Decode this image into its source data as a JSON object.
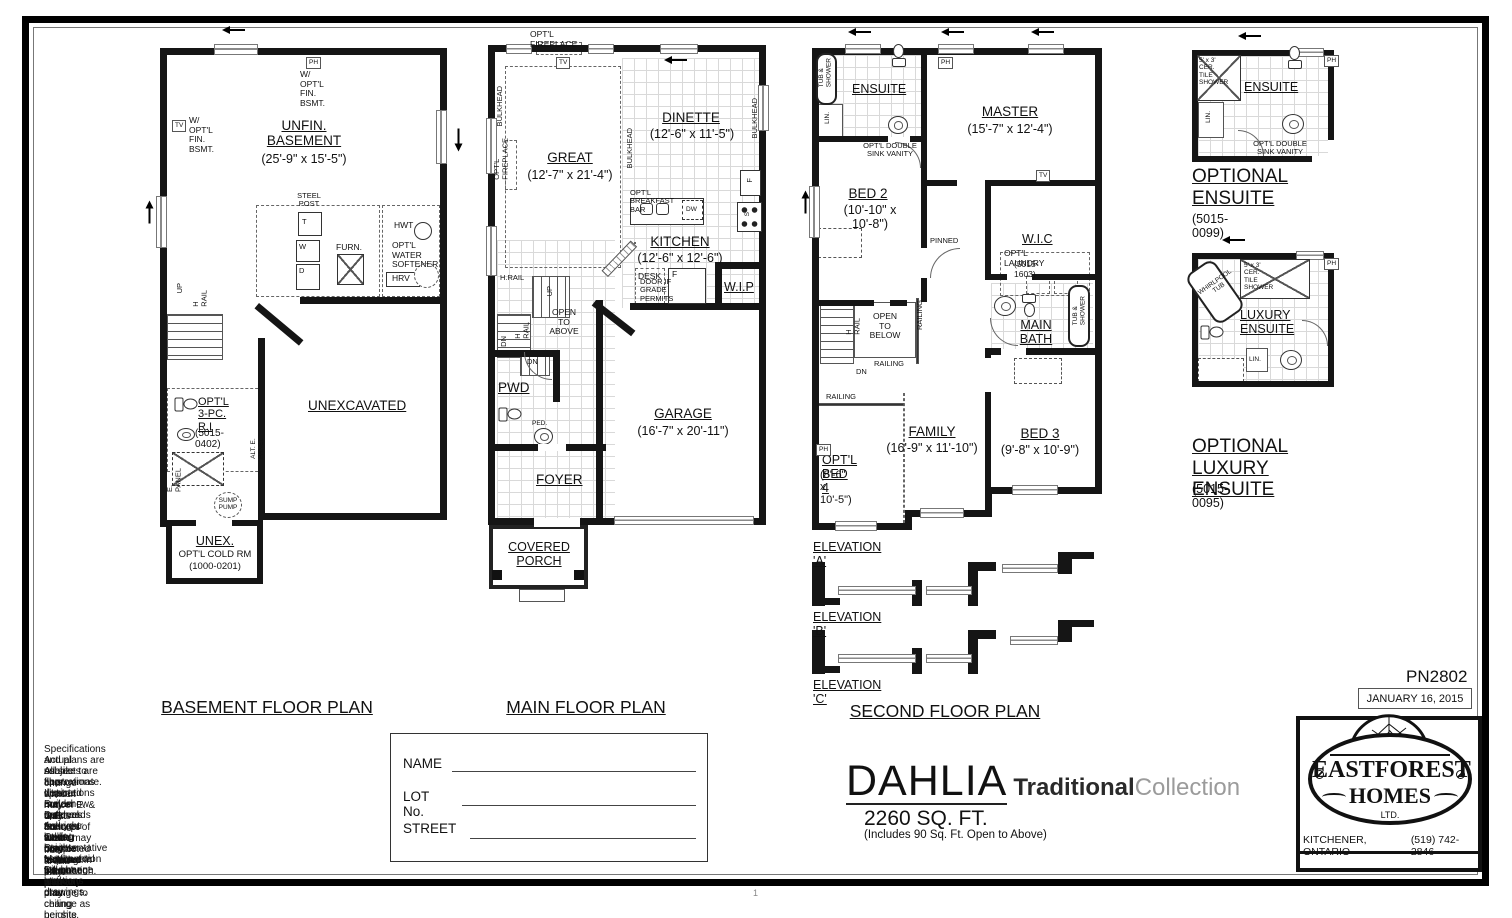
{
  "sheet": {
    "plan_code": "PN2802",
    "date": "JANUARY 16, 2015",
    "page_mark": "1"
  },
  "titles": {
    "basement": "BASEMENT FLOOR PLAN",
    "main": "MAIN FLOOR PLAN",
    "second": "SECOND FLOOR PLAN"
  },
  "model": {
    "name": "DAHLIA",
    "collection_primary": "Traditional",
    "collection_secondary": "Collection",
    "area": "2260 SQ. FT.",
    "area_note": "(Includes 90 Sq. Ft. Open to Above)"
  },
  "logo": {
    "brand_top": "EASTFOREST",
    "brand_bottom": "HOMES",
    "suffix": "LTD.",
    "city": "KITCHENER, ONTARIO",
    "phone": "(519) 742-2846"
  },
  "form": {
    "name": "NAME",
    "lot": "LOT No.",
    "street": "STREET"
  },
  "notes": [
    "Specifications and plans are subject to change without notice.  E. & O.E..",
    "Actual usable floor space may vary from stated floor area.",
    "All sizes are approximate.",
    "Illustrations depicted are an artists concept of the completed building only.",
    "Illustrations may show optional features which may not be included in the base price.",
    "Builder reserves the right to alter or reverse plans.",
    "Bulkheads and boxing may be required.",
    "Ask your sales representative for more information.",
    "Ceiling heights vary from plan to plan.",
    "Stair configuration will change with any change to ceiling heights.",
    "Mechanical equipment locations may change as per site conditions.",
    "Do not scale drawings."
  ],
  "basement": {
    "ph": "PH",
    "tv": "TV",
    "fin_bsmt_top": "W/ OPT'L\nFIN. BSMT.",
    "fin_bsmt_left": "W/ OPT'L\nFIN. BSMT.",
    "room": "UNFIN.\nBASEMENT",
    "room_size": "(25'-9\" x 15'-5\")",
    "steel_post": "STEEL\nPOST",
    "t": "T",
    "w": "W",
    "d": "D",
    "furn": "FURN.",
    "hwt": "HWT",
    "softener": "OPT'L\nWATER\nSOFTENER",
    "hrv": "HRV",
    "up": "UP",
    "h_rail": "H RAIL",
    "optl_3pc": "OPT'L\n3-PC. R.I",
    "optl_3pc_code": "(5015-0402)",
    "e_panel": "E. PANEL",
    "alt_e_panel": "ALT. E. PANEL",
    "sump": "SUMP\nPUMP",
    "unexcavated": "UNEXCAVATED",
    "unex": "UNEX.",
    "cold_rm": "OPT'L COLD RM",
    "cold_code": "(1000-0201)"
  },
  "main": {
    "optl_fireplace_top": "OPT'L FIREPLACE",
    "tv": "TV",
    "bulkhead_left": "BULKHEAD",
    "optl_fireplace_left": "OPT'L\nFIREPLACE",
    "great": "GREAT",
    "great_size": "(12'-7\" x 21'-4\")",
    "bulkhead_mid": "BULKHEAD",
    "bulkhead_right": "BULKHEAD",
    "dinette": "DINETTE",
    "dinette_size": "(12'-6\" x 11'-5\")",
    "breakfast_bar": "OPT'L BREAKFAST BAR",
    "dw": "DW",
    "fridge": "F",
    "stove": "S",
    "kitchen": "KITCHEN",
    "kitchen_size": "(12'-6\" x 12'-6\")",
    "desk": "DESK",
    "f": "F",
    "wip": "W.I.P",
    "door_grade": "DOOR IF\nGRADE\nPERMITS",
    "h_rail": "H.RAIL",
    "up": "UP",
    "open_above": "OPEN\nTO\nABOVE",
    "dn": "DN",
    "h_rail2": "H RAIL",
    "dn2": "DN",
    "pwd": "PWD",
    "ped": "PED.",
    "foyer": "FOYER",
    "garage": "GARAGE",
    "garage_size": "(16'-7\" x 20'-11\")",
    "porch": "COVERED\nPORCH"
  },
  "second": {
    "ensuite": "ENSUITE",
    "tub_shower": "TUB &\nSHOWER",
    "lin": "LIN.",
    "vanity": "OPT'L DOUBLE\nSINK VANITY",
    "ph_top": "PH",
    "ph_left": "PH",
    "tv": "TV",
    "master": "MASTER",
    "master_size": "(15'-7\" x 12'-4\")",
    "bed2": "BED 2",
    "bed2_size": "(10'-10\" x 10'-8\")",
    "pinned": "PINNED",
    "wic": "W.I.C",
    "optl_laundry": "OPT'L LAUNDRY",
    "laundry_code": "(5015-1603)",
    "h_rail": "H RAIL",
    "open_below": "OPEN\nTO\nBELOW",
    "railing_v": "RAILING",
    "railing_h": "RAILING",
    "railing_b": "RAILING",
    "dn": "DN",
    "main_bath": "MAIN\nBATH",
    "tub_shower2": "TUB &\nSHOWER",
    "family": "FAMILY",
    "family_size": "(16'-9\" x 11'-10\")",
    "bed3": "BED 3",
    "bed3_size": "(9'-8\" x 10'-9\")",
    "bed4": "OPT'L BED 4",
    "bed4_size": "(8'-6\" x 10'-5\")",
    "elevations": [
      "ELEVATION 'A'",
      "ELEVATION 'B'",
      "ELEVATION 'C'"
    ]
  },
  "opt_ensuite": {
    "shower": "5' x 3'\nCER. TILE\nSHOWER",
    "name": "ENSUITE",
    "lin": "LIN.",
    "vanity": "OPT'L DOUBLE\nSINK VANITY",
    "ph": "PH",
    "title": "OPTIONAL\nENSUITE",
    "code": "(5015-0099)"
  },
  "opt_luxury": {
    "whirlpool": "WHIRLPOOL\nTUB",
    "shower": "5' x 3'\nCER. TILE\nSHOWER",
    "name": "LUXURY\nENSUITE",
    "lin": "LIN.",
    "ph": "PH",
    "title_line1": "OPTIONAL",
    "title_line2": "LUXURY ENSUITE",
    "code": "(5015-0095)"
  }
}
